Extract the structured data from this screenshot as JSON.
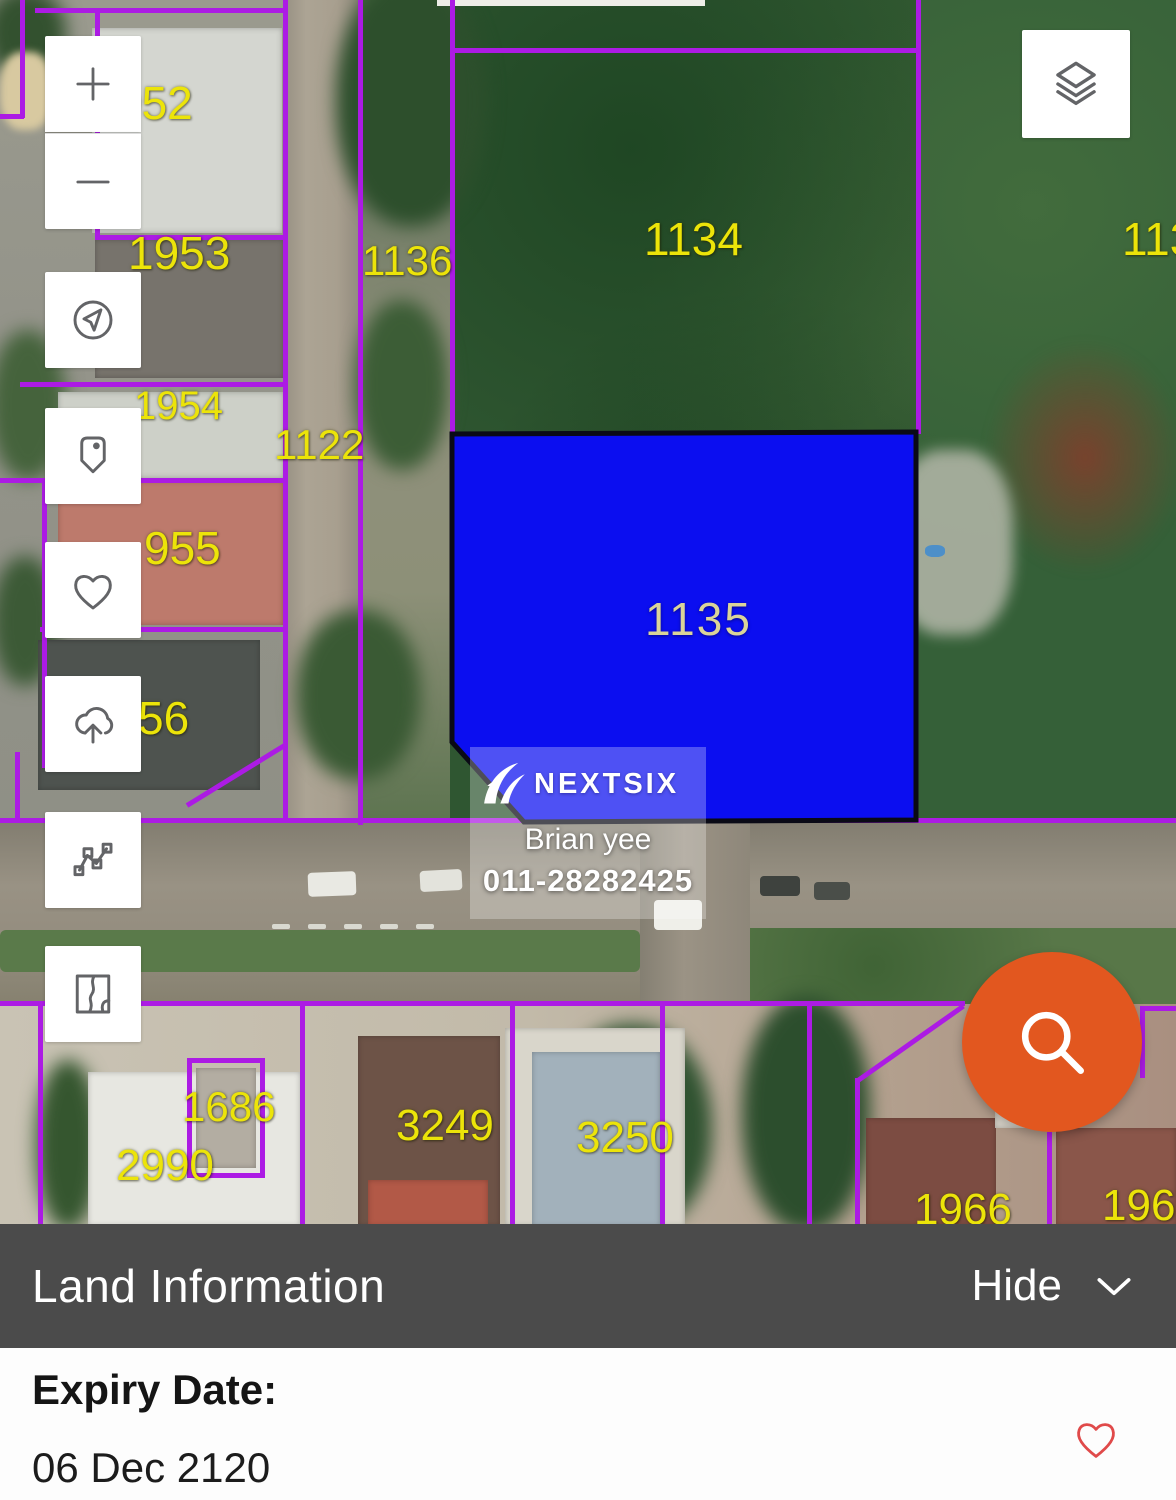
{
  "map": {
    "boundary_color": "#AC1BE4",
    "label_color": "#ECE409",
    "highlight_parcel": {
      "id": "1135",
      "fill": "#0B0EF0",
      "label_color": "#DAD499"
    },
    "labels": [
      {
        "text": "952",
        "x": 116,
        "y": 80,
        "size": 46,
        "kind": "parcel"
      },
      {
        "text": "1953",
        "x": 128,
        "y": 230,
        "size": 46,
        "kind": "parcel"
      },
      {
        "text": "1136",
        "x": 362,
        "y": 240,
        "size": 42,
        "kind": "parcel"
      },
      {
        "text": "1134",
        "x": 644,
        "y": 216,
        "size": 46,
        "kind": "parcel"
      },
      {
        "text": "113",
        "x": 1122,
        "y": 216,
        "size": 46,
        "kind": "parcel"
      },
      {
        "text": "1954",
        "x": 134,
        "y": 386,
        "size": 40,
        "kind": "parcel"
      },
      {
        "text": "1122",
        "x": 274,
        "y": 424,
        "size": 42,
        "kind": "parcel"
      },
      {
        "text": "955",
        "x": 144,
        "y": 525,
        "size": 46,
        "kind": "parcel"
      },
      {
        "text": "56",
        "x": 138,
        "y": 695,
        "size": 46,
        "kind": "parcel"
      },
      {
        "text": "1135",
        "x": 645,
        "y": 596,
        "size": 46,
        "kind": "highlight"
      },
      {
        "text": "1686",
        "x": 182,
        "y": 1086,
        "size": 42,
        "kind": "parcel"
      },
      {
        "text": "2990",
        "x": 116,
        "y": 1144,
        "size": 44,
        "kind": "parcel"
      },
      {
        "text": "3249",
        "x": 396,
        "y": 1104,
        "size": 44,
        "kind": "parcel"
      },
      {
        "text": "3250",
        "x": 576,
        "y": 1116,
        "size": 44,
        "kind": "parcel"
      },
      {
        "text": "1966",
        "x": 914,
        "y": 1188,
        "size": 44,
        "kind": "parcel"
      },
      {
        "text": "1967",
        "x": 1102,
        "y": 1184,
        "size": 44,
        "kind": "parcel"
      }
    ]
  },
  "toolbar": {
    "buttons": [
      {
        "name": "zoom-in"
      },
      {
        "name": "zoom-out"
      },
      {
        "name": "locate"
      },
      {
        "name": "pin"
      },
      {
        "name": "favorite"
      },
      {
        "name": "cloud-upload"
      },
      {
        "name": "measure"
      },
      {
        "name": "map-type"
      }
    ]
  },
  "layers_button": {
    "name": "layers"
  },
  "fab": {
    "name": "search",
    "color": "#E2571F"
  },
  "watermark": {
    "brand": "NEXTSIX",
    "agent": "Brian yee",
    "phone": "011-28282425"
  },
  "panel": {
    "title": "Land Information",
    "hide_label": "Hide",
    "expiry_label": "Expiry Date:",
    "expiry_value": "06 Dec 2120",
    "favorite_color": "#E04A4A"
  }
}
